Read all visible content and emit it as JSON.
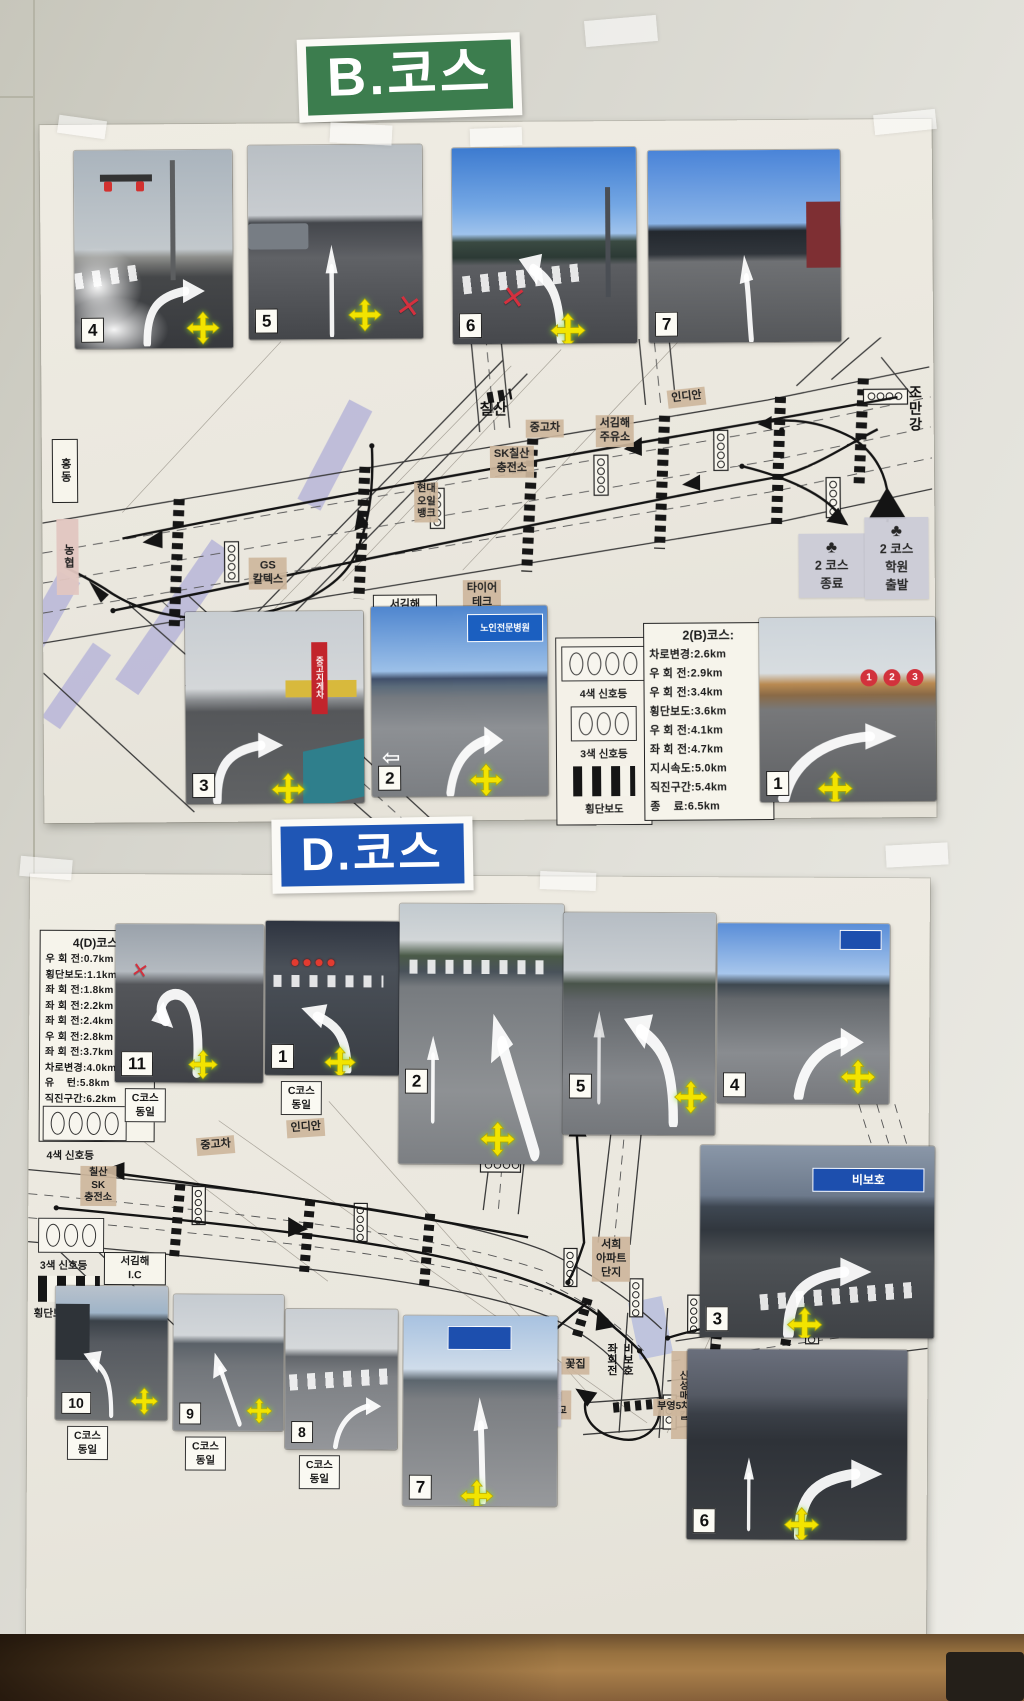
{
  "icons": {
    "red_x": "✕",
    "left_outline_arrow": "⇦"
  },
  "course_b": {
    "title": "B.코스",
    "accent": "#3c7d4e",
    "top_photos": [
      {
        "number": "4"
      },
      {
        "number": "5"
      },
      {
        "number": "6"
      },
      {
        "number": "7"
      }
    ],
    "bottom_photos": [
      {
        "number": "3",
        "sign": "중고지게차"
      },
      {
        "number": "2",
        "sign": "노인전문병원"
      },
      {
        "number": "1",
        "markers": [
          "1",
          "2",
          "3"
        ]
      }
    ],
    "map_labels": {
      "chilsan": "칠산",
      "used_cars": "중고차",
      "sk_station": "SK칠산\n충전소",
      "seogimhae_gas": "서김해\n주유소",
      "indian": "인디안",
      "jomangang": "조만강",
      "hongdong": "홍동",
      "nonghyup": "농협",
      "gs1": "GS\n칼텍스",
      "gs2": "GS\n칼텍스",
      "hyundai_oil": "현대\n오일\n뱅크",
      "tire_tech": "타이어\n테크",
      "ic": "서김해\nI.C"
    },
    "endpoints": {
      "end": {
        "symbol": "♣",
        "label": "2 코스\n종료"
      },
      "start": {
        "symbol": "♣",
        "label": "2 코스\n학원\n출발"
      }
    },
    "legend": {
      "four": "4색 신호등",
      "three": "3색 신호등",
      "cross": "횡단보도"
    },
    "course_info": {
      "title": "2(B)코스:",
      "items": [
        "차로변경:2.6km",
        "우 회 전:2.9km",
        "우 회 전:3.4km",
        "횡단보도:3.6km",
        "우 회 전:4.1km",
        "좌 회 전:4.7km",
        "지시속도:5.0km",
        "직진구간:5.4km",
        "종    료:6.5km"
      ]
    }
  },
  "course_d": {
    "title": "D.코스",
    "accent": "#1f56b5",
    "course_info": {
      "title": "4(D)코스:",
      "items": [
        "우 회 전:0.7km",
        "횡단보도:1.1km",
        "좌 회 전:1.8km",
        "좌 회 전:2.2km",
        "좌 회 전:2.4km",
        "우 회 전:2.8km",
        "좌 회 전:3.7km",
        "차로변경:4.0km",
        "유    턴:5.8km",
        "직진구간:6.2km",
        "지시구간:6.2km",
        "종    료:6.8km"
      ]
    },
    "top_photos": [
      {
        "number": "11",
        "note": "C코스\n동일"
      },
      {
        "number": "1",
        "note": "C코스\n동일"
      },
      {
        "number": "2"
      },
      {
        "number": "5"
      },
      {
        "number": "4"
      }
    ],
    "right_photo": {
      "number": "3",
      "sign": "비보호"
    },
    "bottom_photos": [
      {
        "number": "10",
        "note": "C코스\n동일"
      },
      {
        "number": "9",
        "note": "C코스\n동일"
      },
      {
        "number": "8",
        "note": "C코스\n동일"
      },
      {
        "number": "7"
      },
      {
        "number": "6"
      }
    ],
    "legend": {
      "four": "4색 신호등",
      "three": "3색 신호등",
      "cross": "횡단보도"
    },
    "map_labels": {
      "chilsan_sk": "칠산\nSK\n충전소",
      "used_cars": "중고차",
      "indian": "인디안",
      "haean_gas": "해안\n주유소",
      "jomangang": "조만강",
      "seohui": "서희\n아파트\n단지",
      "ic": "서김해\nI.C",
      "soil": "S-OIL\n주유소",
      "flower": "꽃집",
      "sinseong": "신성매디칼",
      "seokbong": "석봉대동\n1단지",
      "naedeok": "내덕\n중학교",
      "buyeong": "부영5차",
      "bibo": "비보호\n좌회전"
    },
    "endpoints": {
      "end": {
        "symbol": "♣",
        "label": "4 코스\n종료"
      },
      "start": {
        "symbol": "♣",
        "label": "4 코스\n출발"
      }
    }
  }
}
